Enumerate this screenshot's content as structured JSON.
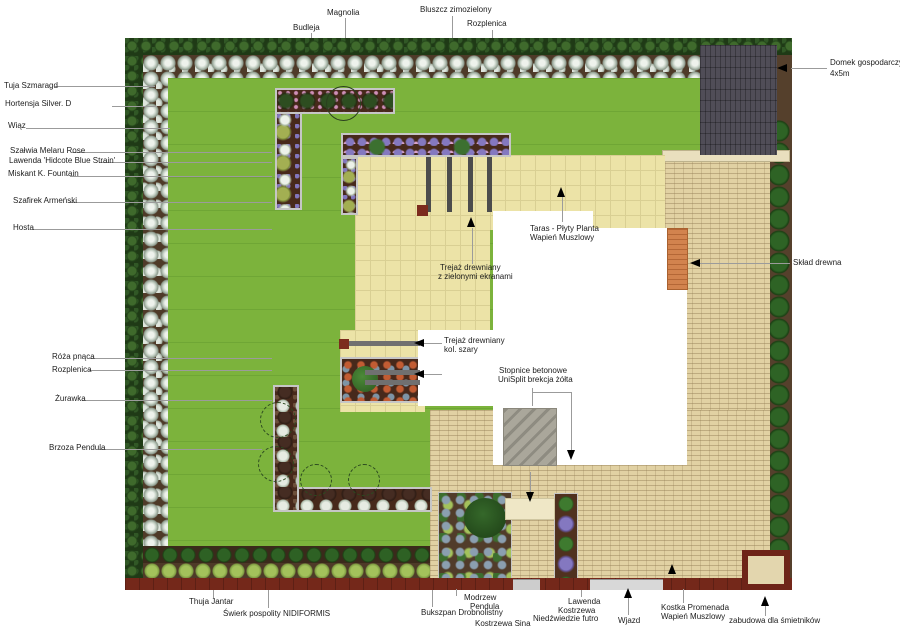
{
  "title": "garden landscape plan",
  "colors": {
    "lawn": "#7cb33c",
    "terrace": "#ece3a7",
    "paver": "#e1d1a3",
    "shed": "#504d57",
    "wall": "#74281a",
    "house": "#ffffff",
    "steps_concrete": "#aaa79b",
    "steps_orange": "#d2834e",
    "hedge": "#2a4d1e",
    "bed_soil": "#47291b"
  },
  "labels": {
    "top": {
      "budleja": "Budleja",
      "magnolia": "Magnolia",
      "bluszcz": "Bluszcz zimozielony",
      "rozplenica": "Rozplenica"
    },
    "left": {
      "tuja": "Tuja Szmaragd",
      "hortensja": "Hortensja Silver. D",
      "wiaz": "Wiąz",
      "szalwia": "Szałwia Melaru Rose",
      "lawenda": "Lawenda 'Hidcote Blue Strain'",
      "miskant": "Miskant K. Fountain",
      "szafirek": "Szafirek Armeński",
      "hosta": "Hosta",
      "roza": "Róża pnąca",
      "rozplenica": "Rozplenica",
      "zurawka": "Żurawka",
      "brzoza": "Brzoza Pendula"
    },
    "right": {
      "domek1": "Domek gospodarczy",
      "domek2": "4x5m",
      "sklad": "Skład drewna"
    },
    "center": {
      "taras1": "Taras - Płyty Planta",
      "taras2": "Wapień Muszlowy",
      "trejaz_zielony1": "Trejaż drewniany",
      "trejaz_zielony2": "z zielonymi ekranami",
      "trejaz_szary1": "Trejaż drewniany",
      "trejaz_szary2": "kol. szary",
      "stopnice1": "Stopnice betonowe",
      "stopnice2": "UniSplit brekcja żółta"
    },
    "bottom": {
      "thuja_jantar": "Thuja Jantar",
      "swierk": "Świerk pospolity NIDIFORMIS",
      "modrzew1": "Modrzew",
      "modrzew2": "Pendula",
      "bukszpan": "Bukszpan Drobnolistny",
      "kostrzewa_sina": "Kostrzewa Sina",
      "lawenda": "Lawenda",
      "kostrzewa_nf1": "Kostrzewa",
      "kostrzewa_nf2": "Niedźwiedzie futro",
      "wjazd": "Wjazd",
      "kostka1": "Kostka Promenada",
      "kostka2": "Wapień Muszlowy",
      "zabudowa": "zabudowa dla śmietników"
    }
  }
}
